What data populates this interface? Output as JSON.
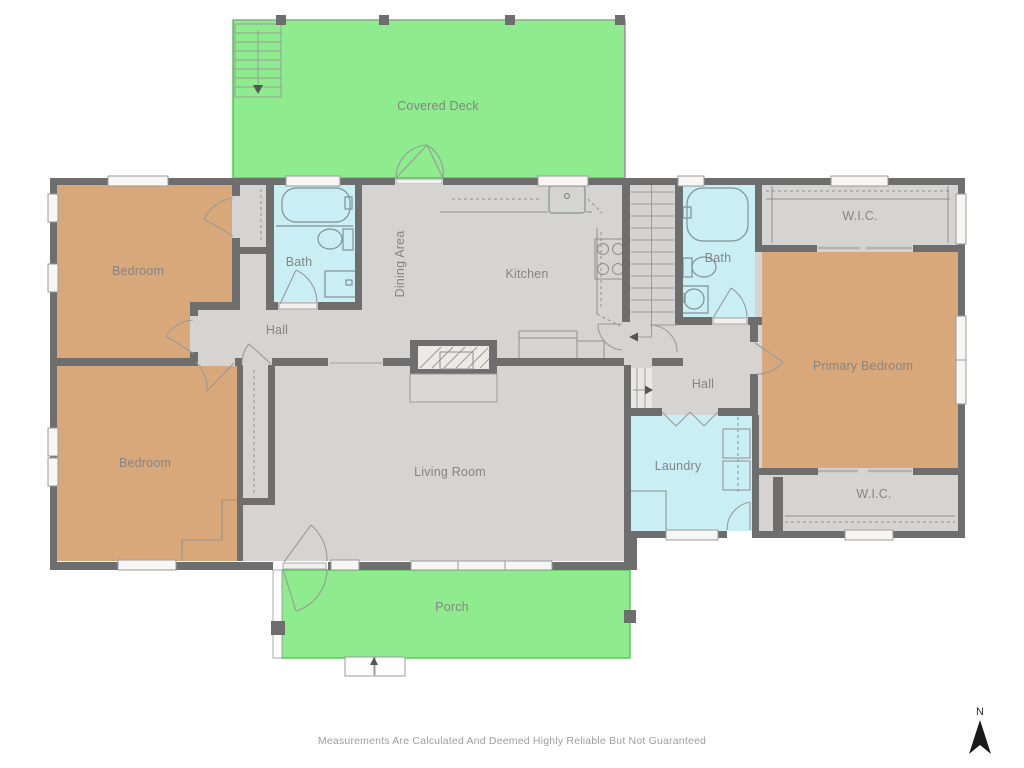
{
  "rooms": {
    "covered_deck": "Covered Deck",
    "bedroom_top_left": "Bedroom",
    "bath_left": "Bath",
    "dining_area": "Dining Area",
    "kitchen": "Kitchen",
    "hall_left": "Hall",
    "bedroom_bottom_left": "Bedroom",
    "living_room": "Living Room",
    "bath_right": "Bath",
    "wic_top": "W.I.C.",
    "primary_bedroom": "Primary Bedroom",
    "hall_right": "Hall",
    "laundry": "Laundry",
    "wic_bottom": "W.I.C.",
    "porch": "Porch"
  },
  "footer": {
    "disclaimer": "Measurements Are Calculated And Deemed Highly Reliable But Not Guaranteed"
  },
  "compass": {
    "north_label": "N"
  },
  "colors": {
    "deck_porch": "#8eec8e",
    "bedroom": "#d8a87b",
    "bathroom": "#c9eef4",
    "floor": "#d5d4d2",
    "wall": "#6e6e6e"
  }
}
